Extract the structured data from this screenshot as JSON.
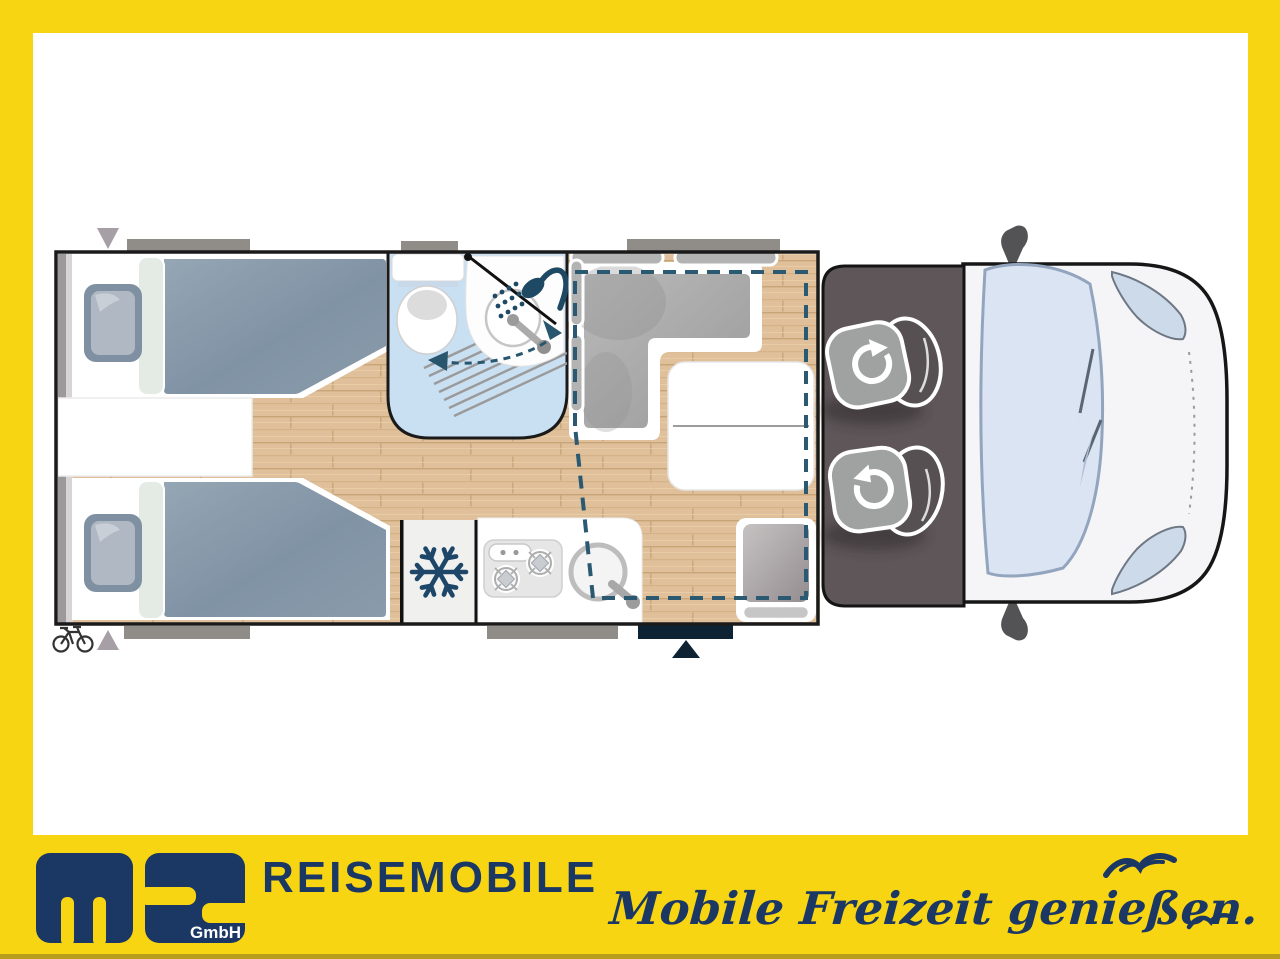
{
  "brand": {
    "company_abbrev": "ms",
    "company_suffix": "GmbH",
    "wordmark": "REISEMOBILE",
    "slogan": "Mobile Freizeit genießen."
  },
  "colors": {
    "frame_yellow": "#F7D512",
    "brand_navy": "#1B3764",
    "floor_wood": "#DFC09A",
    "bathroom_blue": "#C9DFF2",
    "drop_bed_dashed_outline": "#2A5971",
    "sofa_gray": "#ACACAC",
    "cab_floor_gray": "#5E5659",
    "duvet_slate": "#8396A8",
    "van_body_white": "#F5F5F7",
    "windshield_blue": "#DBE4F2",
    "entry_door_dark": "#0D2333",
    "window_bar_gray": "#908D89"
  },
  "floorplan": {
    "icons": [
      {
        "name": "snowflake-icon",
        "meaning": "refrigerator"
      },
      {
        "name": "shower-icon",
        "meaning": "shower"
      },
      {
        "name": "swivel-seat-icon",
        "meaning": "rotating cab seat (driver)"
      },
      {
        "name": "swivel-seat-icon",
        "meaning": "rotating cab seat (passenger)"
      },
      {
        "name": "bicycle-icon",
        "meaning": "rear bicycle storage"
      },
      {
        "name": "entrance-arrow-icon",
        "meaning": "entry door marker"
      },
      {
        "name": "rear-marker-icon",
        "meaning": "rear end marker"
      }
    ]
  }
}
